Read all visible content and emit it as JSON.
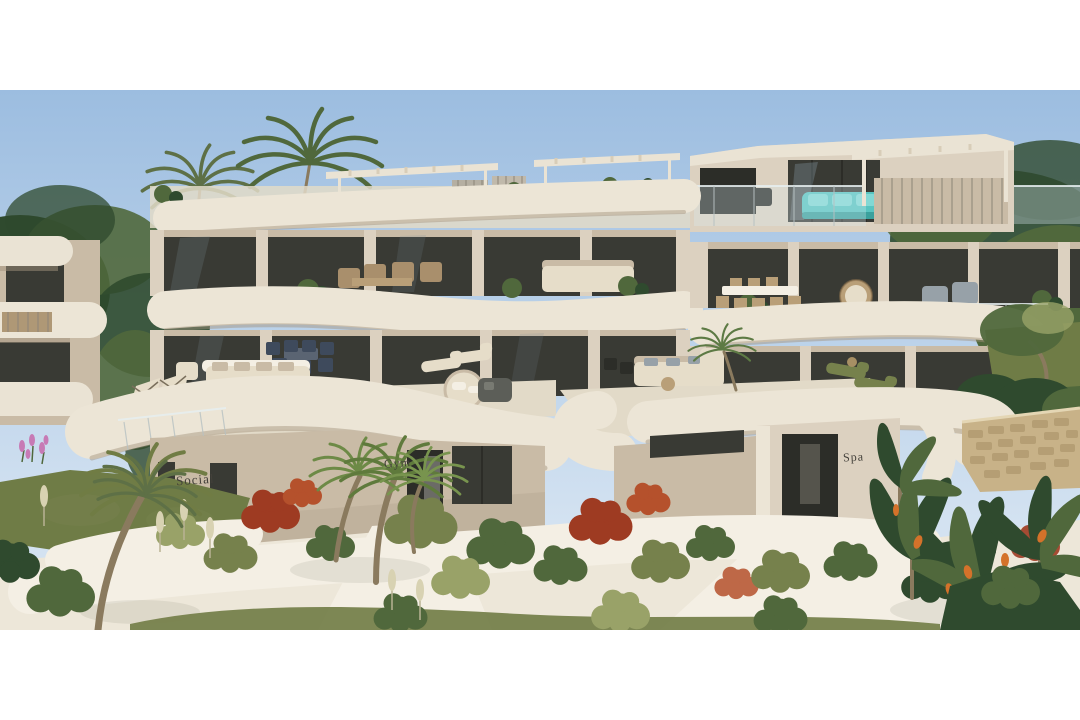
{
  "photo": {
    "description": "3D exterior render of a modern terraced apartment complex with curved white balconies, rooftop pergolas, outdoor furniture, palm trees, gardens and sandy paths",
    "signs": {
      "social": "Social",
      "gym": "Gym",
      "spa": "Spa"
    }
  },
  "palette": {
    "skyTop": "#9cbde0",
    "skyBottom": "#d3e2f1",
    "wallLight": "#eae3d4",
    "wall": "#dcd1c0",
    "wallShade": "#c9bba6",
    "slab": "#ece5d6",
    "soffit": "#a2917b",
    "glass": "#393a34",
    "glassDark": "#2c2d28",
    "reflect": "#7b8b94",
    "floor": "#e2dac8",
    "teal": "#58c4c0",
    "tealLight": "#82d8d4",
    "tealDark": "#3aa19d",
    "navy": "#3e4a5c",
    "tan": "#b99f78",
    "wicker": "#a98f6c",
    "cushion": "#e6ddc9",
    "blueGray": "#97a1a8",
    "greenDark": "#2f4a2e",
    "greenMid": "#50683c",
    "olive": "#76814c",
    "oliveLight": "#99a268",
    "lawn": "#6f7c46",
    "redBush": "#9e3b22",
    "redLight": "#b5512c",
    "sand": "#ede7d9",
    "pathLight": "#f4efe4",
    "stone": "#c8b288",
    "stoneDark": "#a78f64",
    "trunk": "#8a7a5e",
    "orange": "#d4722a",
    "pink": "#c77ab5",
    "pampas": "#d8d2b2",
    "label": "#43403a"
  }
}
